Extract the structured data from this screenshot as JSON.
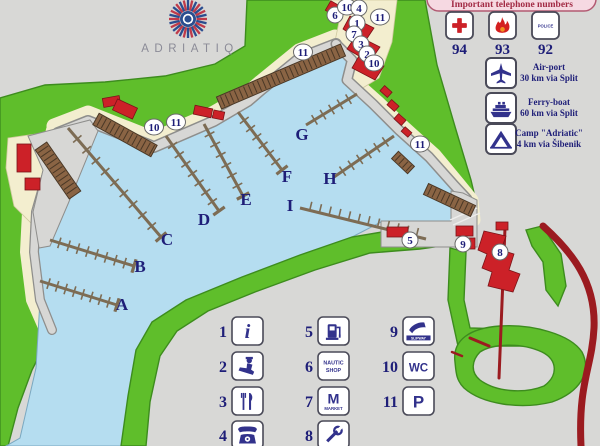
{
  "logo": {
    "brand": "ADRIATIQ"
  },
  "info_panel": {
    "title": "Important telephone numbers",
    "phones": [
      {
        "number": "94",
        "icon": "red-cross-icon"
      },
      {
        "number": "93",
        "icon": "fire-icon"
      },
      {
        "number": "92",
        "icon": "police-icon",
        "badge_text": "POLICE"
      }
    ],
    "transport": [
      {
        "icon": "airplane-icon",
        "line1": "Air-port",
        "line2": "30 km via Split"
      },
      {
        "icon": "ferry-icon",
        "line1": "Ferry-boat",
        "line2": "60 km via Split"
      },
      {
        "icon": "tent-icon",
        "line1": "Camp \"Adriatic\"",
        "line2": "4 km via Šibenik"
      }
    ]
  },
  "map": {
    "markers": [
      {
        "label": "6",
        "x": 335,
        "y": 15
      },
      {
        "label": "10",
        "x": 347,
        "y": 7
      },
      {
        "label": "4",
        "x": 359,
        "y": 8
      },
      {
        "label": "11",
        "x": 380,
        "y": 17
      },
      {
        "label": "1",
        "x": 357,
        "y": 23
      },
      {
        "label": "7",
        "x": 354,
        "y": 34
      },
      {
        "label": "3",
        "x": 361,
        "y": 44
      },
      {
        "label": "2",
        "x": 367,
        "y": 54
      },
      {
        "label": "10",
        "x": 374,
        "y": 63
      },
      {
        "label": "11",
        "x": 303,
        "y": 52
      },
      {
        "label": "10",
        "x": 154,
        "y": 127
      },
      {
        "label": "11",
        "x": 176,
        "y": 122
      },
      {
        "label": "11",
        "x": 420,
        "y": 144
      },
      {
        "label": "5",
        "x": 410,
        "y": 240
      },
      {
        "label": "9",
        "x": 463,
        "y": 244
      },
      {
        "label": "8",
        "x": 500,
        "y": 252
      }
    ],
    "pier_labels": [
      {
        "label": "A",
        "x": 122,
        "y": 310
      },
      {
        "label": "B",
        "x": 140,
        "y": 272
      },
      {
        "label": "C",
        "x": 167,
        "y": 245
      },
      {
        "label": "D",
        "x": 204,
        "y": 225
      },
      {
        "label": "E",
        "x": 246,
        "y": 205
      },
      {
        "label": "F",
        "x": 287,
        "y": 182
      },
      {
        "label": "G",
        "x": 302,
        "y": 140
      },
      {
        "label": "H",
        "x": 330,
        "y": 184
      },
      {
        "label": "I",
        "x": 290,
        "y": 211
      }
    ]
  },
  "legend": {
    "items": [
      {
        "number": "1",
        "icon": "info-icon",
        "text": [
          "i"
        ],
        "col": 0,
        "row": 0
      },
      {
        "number": "2",
        "icon": "customs-officer-icon",
        "text": [],
        "col": 0,
        "row": 1
      },
      {
        "number": "3",
        "icon": "restaurant-icon",
        "text": [],
        "col": 0,
        "row": 2
      },
      {
        "number": "4",
        "icon": "telephone-icon",
        "text": [],
        "col": 0,
        "row": 3
      },
      {
        "number": "5",
        "icon": "fuel-pump-icon",
        "text": [],
        "col": 1,
        "row": 0
      },
      {
        "number": "6",
        "icon": "nautic-shop-icon",
        "text": [
          "NAUTIC",
          "SHOP"
        ],
        "col": 1,
        "row": 1
      },
      {
        "number": "7",
        "icon": "market-icon",
        "text": [
          "M",
          "MARKET"
        ],
        "col": 1,
        "row": 2
      },
      {
        "number": "8",
        "icon": "wrench-icon",
        "text": [],
        "col": 1,
        "row": 3
      },
      {
        "number": "9",
        "icon": "slipway-icon",
        "text": [
          "SLIPWAY"
        ],
        "col": 2,
        "row": 0
      },
      {
        "number": "10",
        "icon": "wc-icon",
        "text": [
          "WC"
        ],
        "col": 2,
        "row": 1
      },
      {
        "number": "11",
        "icon": "parking-icon",
        "text": [
          "P"
        ],
        "col": 2,
        "row": 2
      }
    ]
  },
  "colors": {
    "bg": "#d8d8d6",
    "land_green": "#5fbe2b",
    "land_stroke": "#3d8c1e",
    "water_blue": "#b5ddf0",
    "water_stroke": "#7aa8c0",
    "quay_gray": "#d7d7d5",
    "quay_stroke": "#8e8e8c",
    "shore_beige": "#f3eecf",
    "pier_brown": "#8a6444",
    "pier_dark": "#4a3826",
    "finger_pier": "#7d6c54",
    "building_red": "#cc2128",
    "road_dark_red": "#9b1b20",
    "icon_purple": "#32328c",
    "text_navy": "#1e1e78",
    "panel_pink": "#f6d9e2",
    "panel_title_red": "#a22a44",
    "logo_red": "#bf3a4a",
    "logo_blue": "#2b4d8f",
    "brand_gray": "#8b8b97"
  }
}
